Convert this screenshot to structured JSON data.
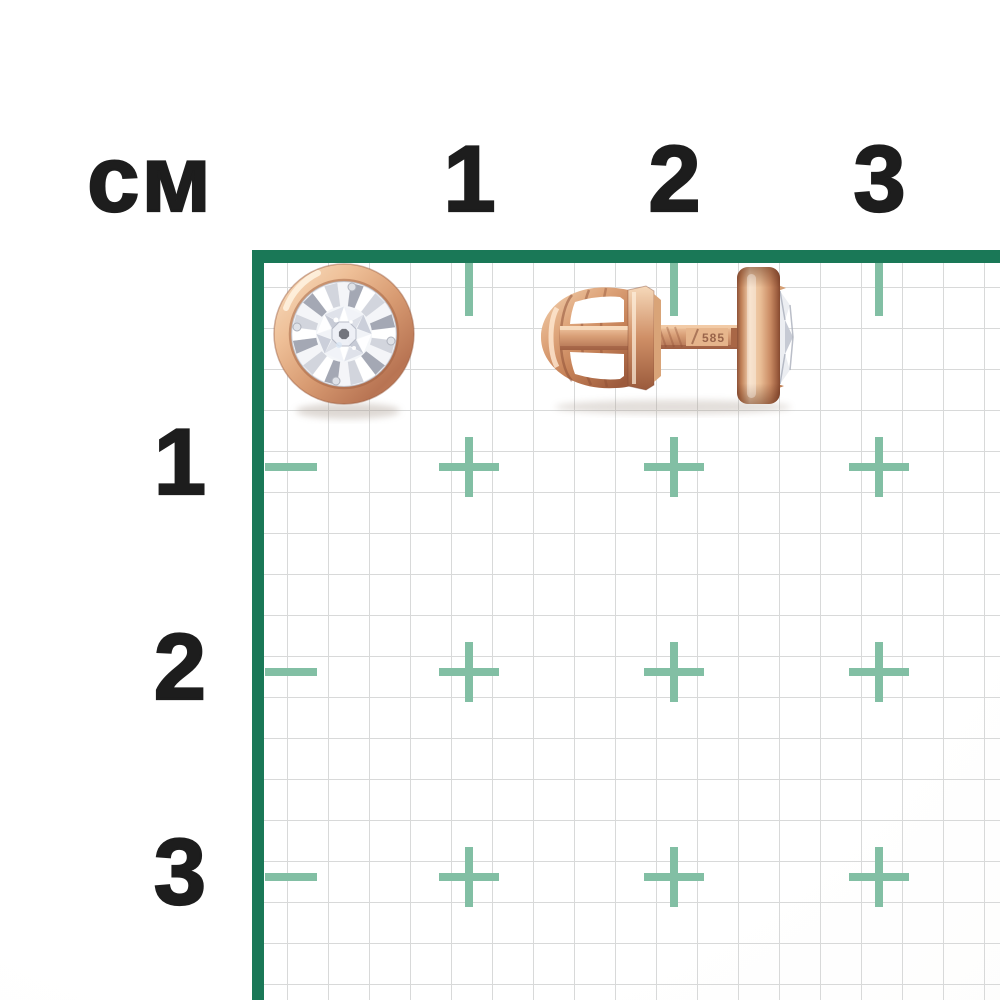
{
  "ruler": {
    "unit_label": "см",
    "top_labels": [
      "1",
      "2",
      "3"
    ],
    "left_labels": [
      "1",
      "2",
      "3"
    ]
  },
  "product": {
    "hallmark_stamp": "585"
  },
  "colors": {
    "ink": "#1d1d1d",
    "border_green": "#1a7857",
    "tick_teal": "#82bfa4",
    "grid_line": "#d8d9d9",
    "rose_gold": "#d89b72",
    "stone_silver": "#eef0f5"
  }
}
